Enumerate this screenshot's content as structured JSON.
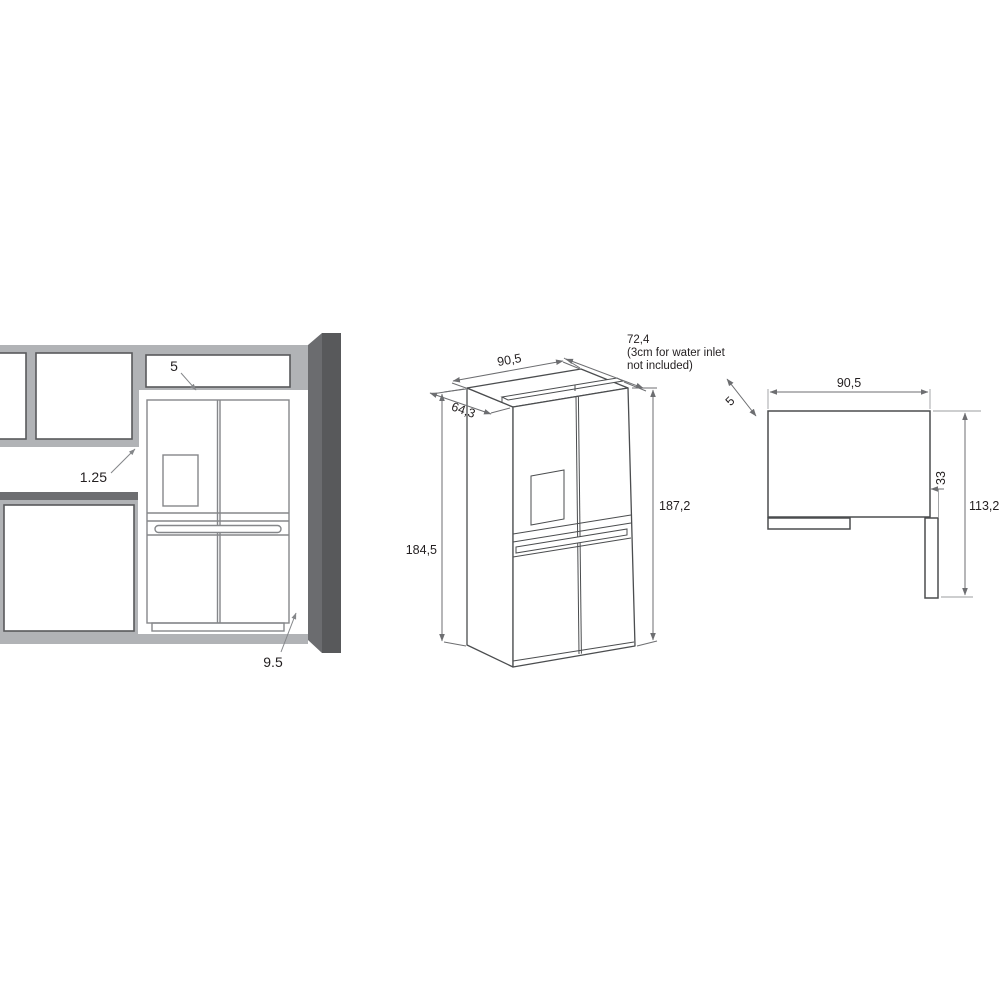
{
  "title": "Refrigerator built-in installation dimensions drawing",
  "views": {
    "front": {
      "name": "front installation view in kitchen niche",
      "labels": {
        "top_clearance": "5",
        "upper_cabinet_clearance": "1.25",
        "wall_clearance": "9.5"
      }
    },
    "isometric": {
      "name": "isometric view of 4-door refrigerator",
      "labels": {
        "width": "90,5",
        "depth_total": "72,4",
        "depth_note_line1": "(3cm for water inlet",
        "depth_note_line2": "not included)",
        "depth_body": "64,3",
        "height_body": "184,5",
        "height_total": "187,2"
      }
    },
    "top": {
      "name": "top view with door open",
      "labels": {
        "width": "90,5",
        "rear_clearance": "5",
        "door_projection": "33",
        "depth_door_open": "113,2"
      }
    }
  },
  "colors": {
    "background": "#ffffff",
    "cabinet_gray": "#b1b3b6",
    "counter_dark_gray": "#6d6e71",
    "wall_front": "#6b6c6f",
    "wall_side": "#58595b",
    "fridge_line_light": "#85878a",
    "drawing_line": "#4b4d4f",
    "dimension_line": "#6d6e71",
    "text": "#231f20"
  }
}
